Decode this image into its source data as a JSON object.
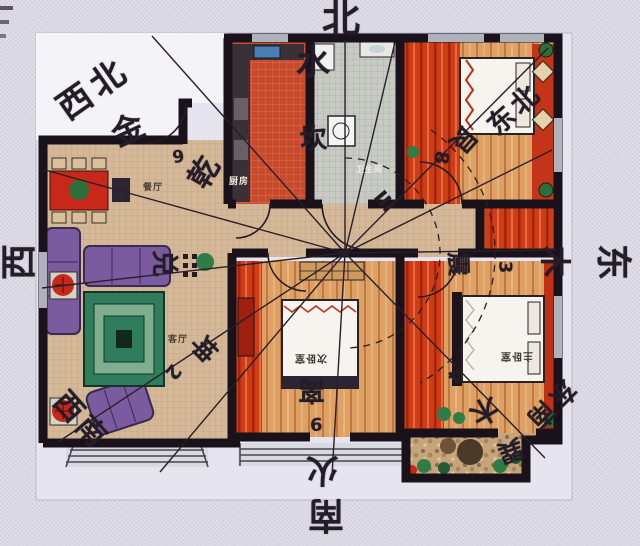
{
  "compass": {
    "north": {
      "direction": "北",
      "element": "水",
      "trigram": "坎"
    },
    "northeast": {
      "direction": "东北",
      "trigram": "艮",
      "number": "8"
    },
    "east": {
      "direction": "东",
      "element": "木",
      "trigram": "震",
      "number": "3"
    },
    "southeast": {
      "direction": "东南",
      "element": "木",
      "trigram": "巽",
      "number": "4"
    },
    "south": {
      "direction": "南",
      "element": "火",
      "trigram": "离",
      "number": "9"
    },
    "southwest": {
      "direction": "西南",
      "trigram": "坤",
      "number": "2"
    },
    "west": {
      "direction": "西",
      "trigram": "兑"
    },
    "northwest": {
      "direction": "西北",
      "element": "金",
      "trigram": "乾",
      "number": "6"
    }
  },
  "rooms": {
    "kitchen": "厨房",
    "bathroom": "卫生间",
    "dining": "餐厅",
    "living": "客厅",
    "secondary_bedroom": "次卧室",
    "master_bedroom": "主卧室"
  },
  "colors": {
    "wall": "#19121b",
    "kitchen_floor": "#c84a2c",
    "wood_floor": "#dda165",
    "red_floor": "#cc3d18",
    "tan_floor": "#d5b897",
    "bath_floor": "#c7cbc3",
    "sofa_purple": "#7b5ba0",
    "rug_green": "#2f7d5c",
    "accent_red": "#c8281a",
    "paper": "#f4f3f7",
    "background": "#d9d7e3"
  }
}
